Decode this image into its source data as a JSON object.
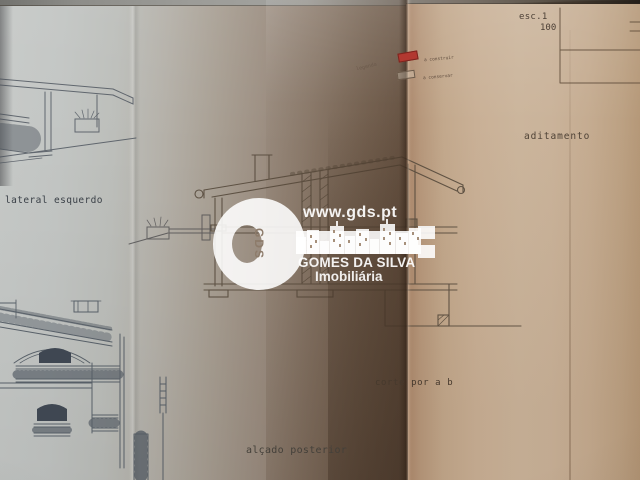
{
  "scale": {
    "label": "esc.1",
    "value": "100"
  },
  "legend": {
    "title": "legenda",
    "items": [
      {
        "label": "a construir",
        "swatch": "red-filled"
      },
      {
        "label": "a conservar",
        "swatch": "outline"
      }
    ]
  },
  "drawing_labels": {
    "left_elevation": "lateral esquerdo",
    "addendum": "aditamento",
    "section": "corte por a b",
    "rear_elevation": "alçado posterior"
  },
  "watermark": {
    "website": "www.gds.pt",
    "monogram": "GDS",
    "company": "GOMES DA SILVA",
    "tagline": "Imobiliária"
  },
  "colors": {
    "legend_red": "#b23830",
    "paper_left_gray": "#c3c6c4",
    "paper_right_tan": "#c9b096",
    "fold_shadow_brown": "#5f4a38",
    "ink_left": "#47505a",
    "ink_right": "#564a3c",
    "watermark_white": "#ffffff"
  }
}
